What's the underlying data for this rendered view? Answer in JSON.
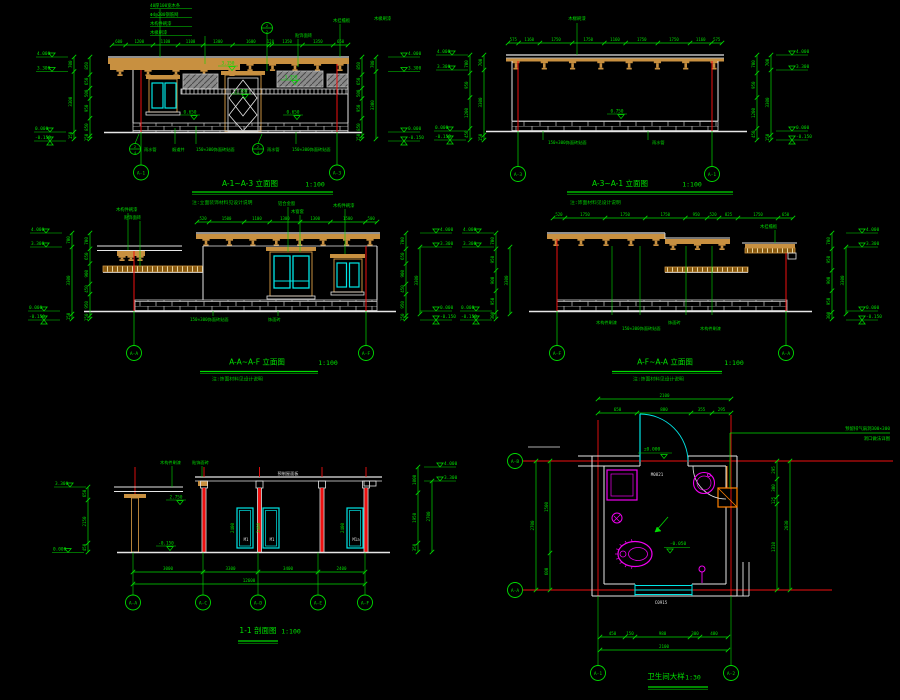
{
  "app": {
    "background": "#000000"
  },
  "colors": {
    "dim_green": "#00dc00",
    "outline_white": "#e6e6e6",
    "wood_tan": "#c89040",
    "window_cyan": "#00e6e6",
    "axis_red": "#f01010",
    "fixture_magenta": "#f000f0",
    "vent_orange": "#ff8000",
    "band_gray": "#909090"
  },
  "titles": {
    "d1": {
      "t": "A-1~A-3 立面图",
      "s": "1:100",
      "note": "注:立面装饰材料见设计说明"
    },
    "d2": {
      "t": "A-3~A-1 立面图",
      "s": "1:100",
      "note": "注:饰面材料见设计说明"
    },
    "d3": {
      "t": "A-A~A-F 立面图",
      "s": "1:100",
      "note": "注:饰面材料见设计说明"
    },
    "d4": {
      "t": "A-F~A-A 立面图",
      "s": "1:100",
      "note": "注:饰面材料见设计说明"
    },
    "d5": {
      "t": "1-1 剖面图",
      "s": "1:100"
    },
    "d6": {
      "t": "卫生间大样",
      "s": "1:30"
    }
  },
  "d1": {
    "grid_labels": [
      "A-1",
      "A-3"
    ],
    "top_dims": [
      "600",
      "1200",
      "1100",
      "1100",
      "1300",
      "1600",
      "120",
      "1350",
      "1350",
      "650"
    ],
    "ann_top": [
      "40厚100宽木条",
      "Φ4@200钢筋网",
      "木构件刷漆",
      "木椽刷漆"
    ],
    "ann_mid": [
      "贴饰面砖",
      "木挂檐板",
      "木椽刷漆"
    ],
    "callout1": {
      "top": "2",
      "bottom": "2"
    },
    "callout2": {
      "top": "2",
      "bottom": "4"
    },
    "callout3": {
      "top": "2",
      "bottom": "4"
    },
    "levels_left": [
      "4.000",
      "3.300",
      "0.000",
      "-0.150"
    ],
    "levels_right": [
      "4.000",
      "3.300",
      "0.000",
      "-0.150"
    ],
    "dims_outer": [
      "700",
      "3300",
      "150"
    ],
    "dims_inner": [
      "850",
      "650",
      "500",
      "950",
      "850",
      "150"
    ],
    "levels_inner": [
      "3.150",
      "2.780",
      "3.350",
      "0.650",
      "0.650"
    ],
    "notes_bottom": [
      "雨水管",
      "烟道井",
      "150×300饰面砖贴面",
      "雨水管",
      "150×300饰面砖贴面"
    ]
  },
  "d2": {
    "grid_labels": [
      "A-3",
      "A-1"
    ],
    "top_dims": [
      "575",
      "1160",
      "1750",
      "1750",
      "1160",
      "1750",
      "1750",
      "1160",
      "575"
    ],
    "ann_top": "木椽刷漆",
    "level_inner": "0.750",
    "levels_left": [
      "4.000",
      "3.300",
      "0.000",
      "-0.150"
    ],
    "levels_right": [
      "4.000",
      "3.300",
      "0.000",
      "-0.150"
    ],
    "dims_inner": [
      "700",
      "950",
      "1200",
      "450"
    ],
    "dims_outer": [
      "700",
      "3300",
      "150"
    ],
    "notes_bottom": [
      "150×300饰面砖贴面",
      "雨水管"
    ]
  },
  "d3": {
    "grid_labels": [
      "A-A",
      "A-F"
    ],
    "top_dims": [
      "520",
      "1500",
      "1100",
      "1300",
      "1300",
      "1500",
      "500"
    ],
    "ann": [
      "木构件刷漆",
      "贴饰面砖",
      "铝合金窗",
      "木窗套",
      "木构件刷漆"
    ],
    "levels_left": [
      "4.000",
      "3.300",
      "0.000",
      "-0.150"
    ],
    "levels_right": [
      "4.000",
      "3.300",
      "0.000",
      "-0.150"
    ],
    "dims_inner": [
      "700",
      "650",
      "900",
      "450",
      "950",
      "150"
    ],
    "dims_outer": [
      "700",
      "3300",
      "150"
    ],
    "notes_bottom": [
      "150×300饰面砖贴面",
      "饰面砖"
    ]
  },
  "d4": {
    "grid_labels": [
      "A-F",
      "A-A"
    ],
    "top_dims": [
      "520",
      "1750",
      "1750",
      "1750",
      "950",
      "520",
      "825",
      "1750",
      "650"
    ],
    "ann_right": "木挂檐板",
    "levels_left": [
      "4.000",
      "3.300",
      "0.000",
      "-0.150"
    ],
    "levels_right": [
      "4.000",
      "3.300",
      "0.000",
      "-0.150"
    ],
    "dims_inner": [
      "700",
      "950",
      "900",
      "950",
      "300"
    ],
    "dims_outer": [
      "3300"
    ],
    "notes_bottom": [
      "木构件刷漆",
      "150×300饰面砖贴面",
      "饰面砖",
      "木构件刷漆"
    ]
  },
  "d5": {
    "grid_labels": [
      "A-A",
      "A-C",
      "A-D",
      "A-E",
      "A-F"
    ],
    "bottom_dims": [
      "3000",
      "3300",
      "3400",
      "2400"
    ],
    "bottom_total": "12600",
    "slab_note": "预制屋面板",
    "ann_top": [
      "木构件刷漆",
      "贴饰面砖"
    ],
    "level_pergola": "2.750",
    "level_ground": "-0.150",
    "door_height": "2400",
    "door_tags": [
      "M1",
      "M1",
      "M1a"
    ],
    "levels_left": [
      "3.300",
      "0.000"
    ],
    "dims_left": [
      "650",
      "2150",
      "450"
    ],
    "levels_right": [
      "4.000",
      "3.300"
    ],
    "dims_right_inner": [
      "1000",
      "1950",
      "350"
    ],
    "dims_right_outer": [
      "2700"
    ]
  },
  "d6": {
    "grid_left_top": "A-B",
    "grid_left_bottom": "A-A",
    "grid_bottom_left": "A-1",
    "grid_bottom_right": "A-2",
    "top_dims": [
      "650",
      "880",
      "355",
      "295"
    ],
    "top_total": "2100",
    "left_dims": [
      "1500",
      "600"
    ],
    "left_total": "2700",
    "right_dims": [
      "295",
      "300",
      "125",
      "1310"
    ],
    "right_total": "2030",
    "bottom_dims": [
      "450",
      "150",
      "980",
      "300",
      "480"
    ],
    "bottom_total": "2100",
    "level_door": "±0.000",
    "level_floor": "-0.050",
    "door_tag": "M0821",
    "window_tag": "C0915",
    "vent_note1": "预留排气扇洞300×300",
    "vent_note2": "洞口做法详图"
  }
}
